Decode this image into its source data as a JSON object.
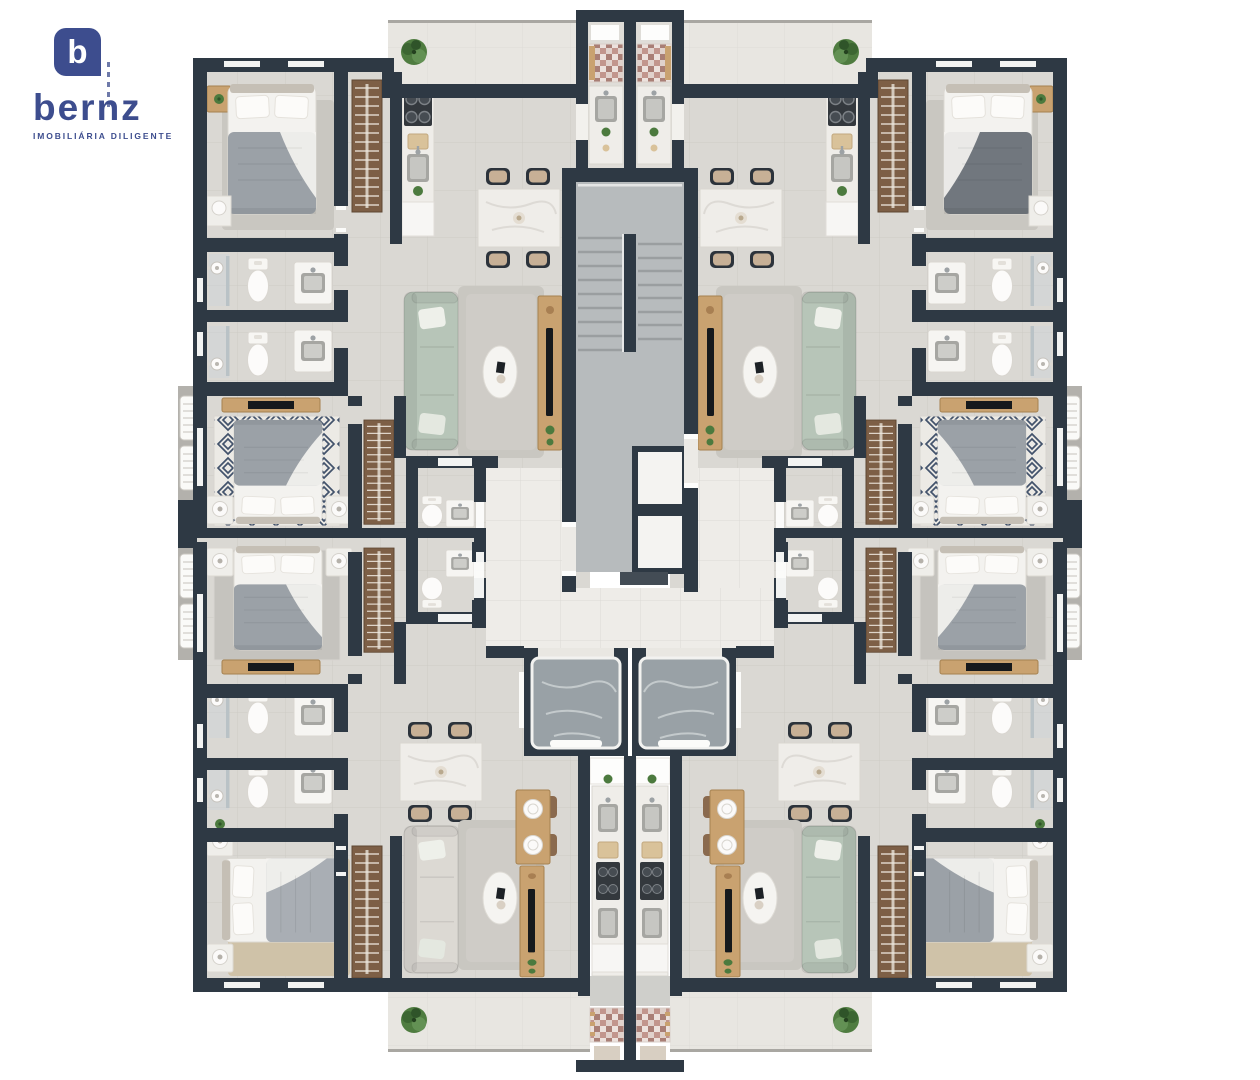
{
  "brand": {
    "monogram": "b",
    "name": "bernz",
    "tagline": "IMOBILIÁRIA DILIGENTE"
  },
  "scene": {
    "kind": "residential-floor-plan-render",
    "apartment_units": 4,
    "elevators": 2,
    "stairwells": 1,
    "icons": [
      "bed",
      "wardrobe",
      "sofa",
      "tv-console",
      "dining-table",
      "kitchen-counter",
      "stove",
      "sink",
      "toilet",
      "vanity",
      "shower-head",
      "washer-area",
      "ac-unit",
      "plant",
      "stairs",
      "elevator"
    ]
  },
  "palette": {
    "logo": "#3d4d8e",
    "wall": "#2e3944",
    "floor": "#dad8d3",
    "floorLine": "#c2c0bb",
    "hall": "#eeece8",
    "balcony": "#e8e6e1",
    "stair": "#b7bbbd",
    "stairLine": "#9a9ea0",
    "elevator": "#99a1a6",
    "marble": "#efede9",
    "wood": "#c9a270",
    "woodDark": "#a5814f",
    "wardrobe": "#7d5f46",
    "sofaGreen": "#b7c5b8",
    "sofaCream": "#dcd9d3",
    "sheet": "#f3f2ef",
    "blanket": "#9ba1a7",
    "blanketDark": "#71777e",
    "blanketSoft": "#a9aeb4",
    "rug": "#c9c7c1",
    "rugTan": "#cfc2a8",
    "rugNavy": "#42526b",
    "mosaic": "#c1968d",
    "fixture": "#f7f6f3",
    "fixtureLine": "#d9d6d0",
    "steel": "#a6a6a2",
    "stove": "#33383d",
    "glass": "#ccd5d9",
    "plant": "#4c7a3e",
    "ledge": "#b3b1ac",
    "white": "#fdfdfc"
  }
}
